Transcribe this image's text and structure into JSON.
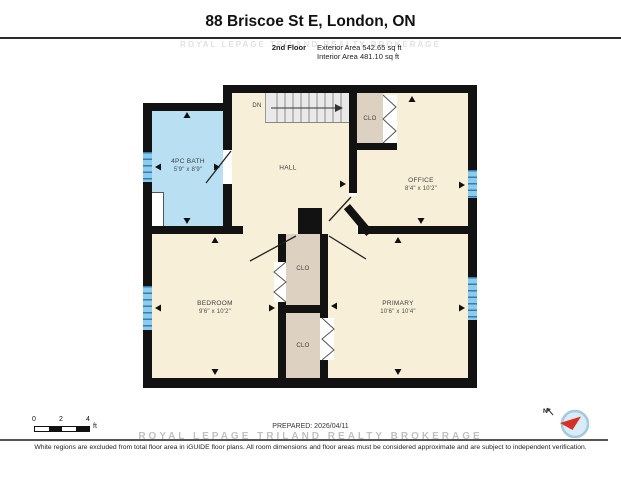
{
  "header": {
    "title": "88 Briscoe St E, London, ON",
    "floor_label": "2nd Floor",
    "exterior_area": "Exterior Area 542.65 sq ft",
    "interior_area": "Interior Area 481.10 sq ft",
    "watermark": "ROYAL LEPAGE TRILAND REALTY BROKERAGE"
  },
  "rooms": {
    "bath": {
      "name": "4PC BATH",
      "dims": "5'9\" x 8'9\""
    },
    "hall": {
      "name": "HALL"
    },
    "stairs": {
      "label": "DN"
    },
    "closet_top": {
      "label": "CLO"
    },
    "office": {
      "name": "OFFICE",
      "dims": "8'4\" x 10'2\""
    },
    "bedroom": {
      "name": "BEDROOM",
      "dims": "9'6\" x 10'2\""
    },
    "closet_upper": {
      "label": "CLO"
    },
    "closet_lower": {
      "label": "CLO"
    },
    "primary": {
      "name": "PRIMARY",
      "dims": "10'6\" x 10'4\""
    }
  },
  "footer": {
    "scale_ticks": [
      "0",
      "2",
      "4"
    ],
    "scale_unit": "ft",
    "prepared": "PREPARED: 2026/04/11",
    "watermark": "ROYAL LEPAGE TRILAND REALTY BROKERAGE",
    "disclaimer": "White regions are excluded from total floor area in iGUIDE floor plans. All room dimensions and floor areas must be considered approximate and are subject to independent verification.",
    "compass_label": "N"
  },
  "colors": {
    "wall": "#121212",
    "floor_cream": "#f7efd7",
    "bath_blue": "#b9dff2",
    "closet_tan": "#ddd2c2",
    "stairs_grey": "#e9e9e9",
    "window_blue": "#4a9fd4",
    "compass_red": "#d93025"
  }
}
